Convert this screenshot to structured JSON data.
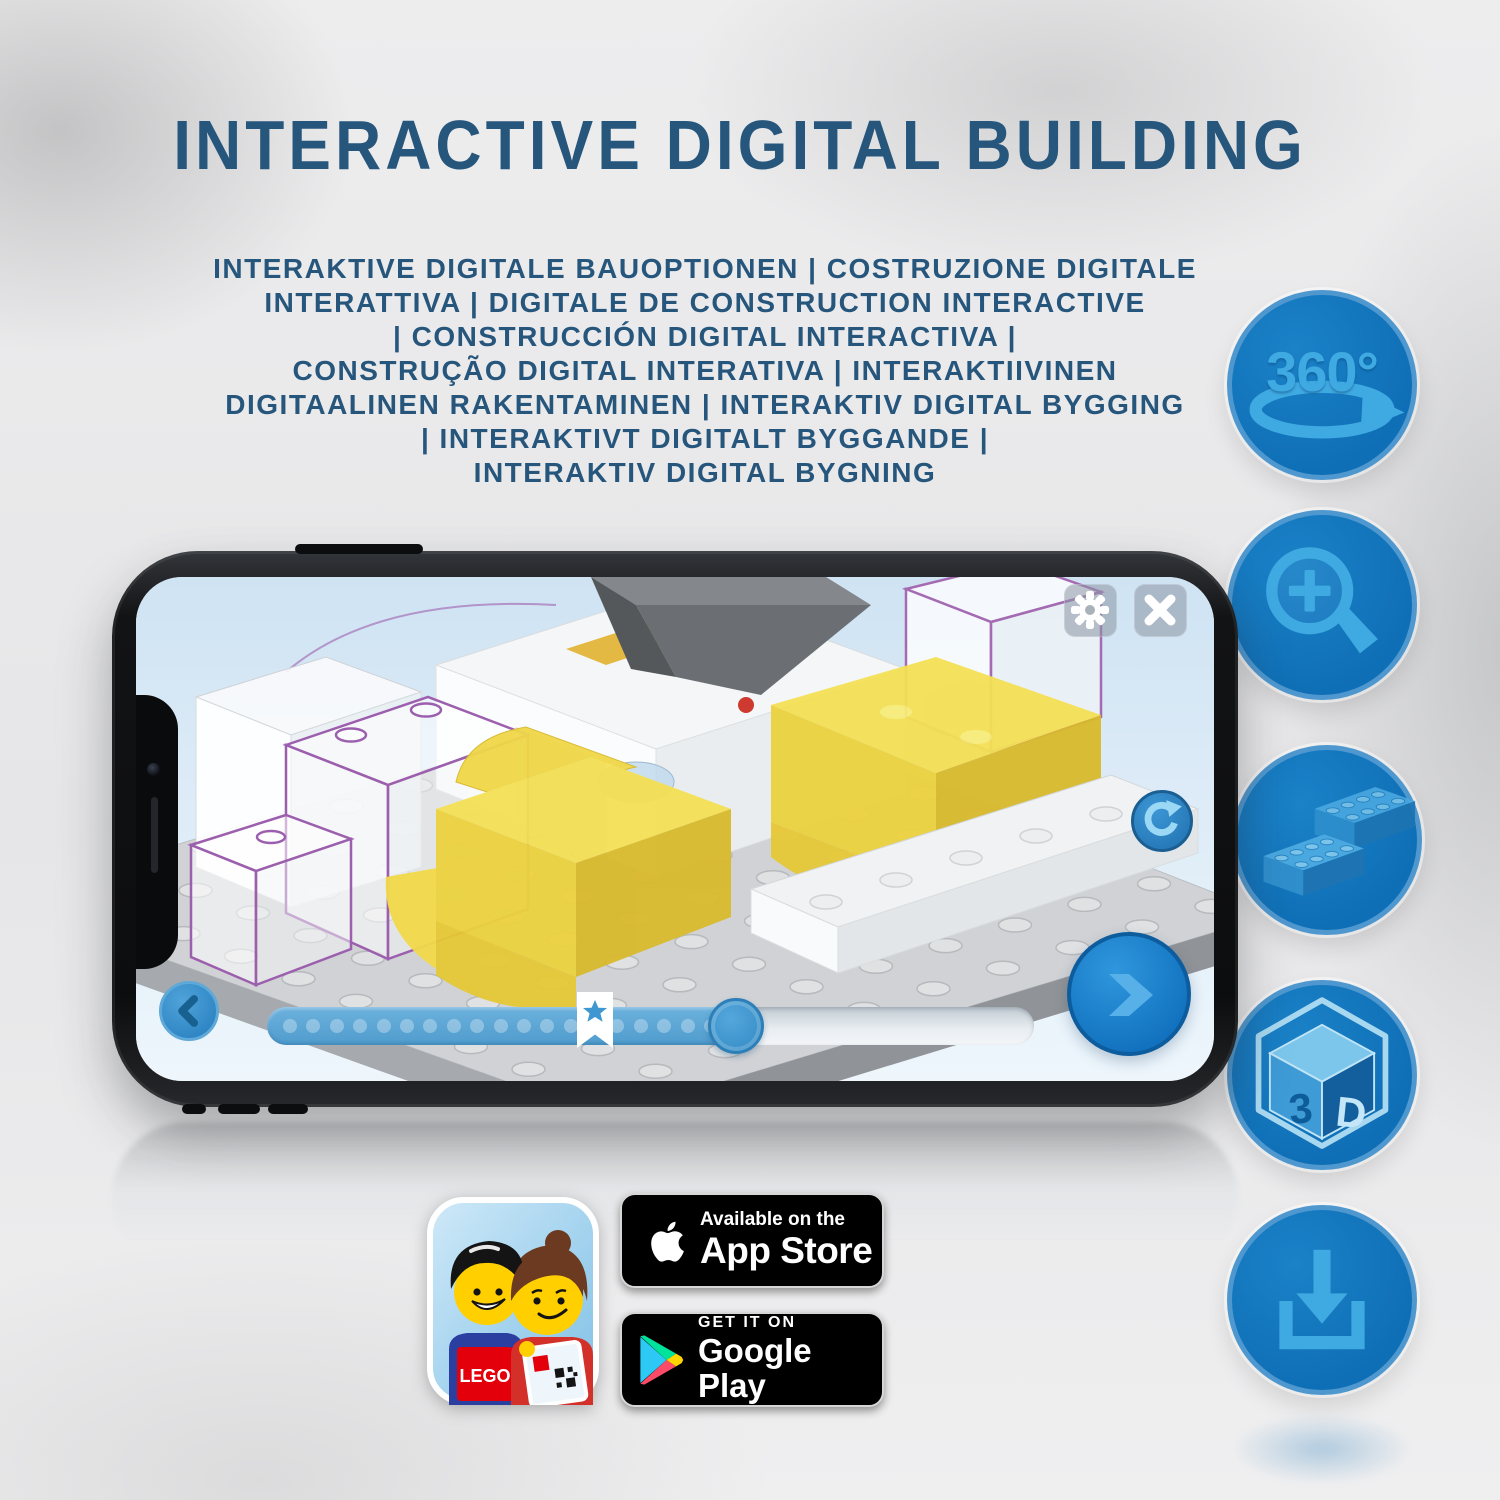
{
  "title": "INTERACTIVE DIGITAL BUILDING",
  "subtitle_lines": [
    "INTERAKTIVE DIGITALE BAUOPTIONEN | COSTRUZIONE DIGITALE",
    "INTERATTIVA | DIGITALE DE CONSTRUCTION INTERACTIVE",
    "| CONSTRUCCIÓN DIGITAL INTERACTIVA |",
    "CONSTRUÇÃO DIGITAL INTERATIVA | INTERAKTIIVINEN",
    "DIGITAALINEN RAKENTAMINEN | INTERAKTIV DIGITAL BYGGING",
    "| INTERAKTIVT DIGITALT BYGGANDE |",
    "INTERAKTIV DIGITAL BYGNING"
  ],
  "feature_icons": {
    "rotate_360": {
      "label": "360°"
    },
    "zoom": {
      "name": "zoom-in-magnifier"
    },
    "bricks": {
      "name": "lego-bricks"
    },
    "cube_3d": {
      "face_left": "3",
      "face_right": "D"
    },
    "download": {
      "name": "download"
    }
  },
  "phone_app": {
    "progress": {
      "dot_count": 20
    }
  },
  "store_badges": {
    "app_store": {
      "line1": "Available on the",
      "line2": "App Store"
    },
    "google_play": {
      "line1": "GET IT ON",
      "line2": "Google Play"
    }
  },
  "app_icon": {
    "logo_text": "LEGO"
  },
  "colors": {
    "heading_blue": "#27567d",
    "icon_circle_blue": "#0f6fb6",
    "icon_glyph_blue": "#3fa9e1",
    "screen_background": "#d7e8f6",
    "lego_yellow": "#f2dc4a",
    "ui_button_blue": "#2f8ccc"
  }
}
